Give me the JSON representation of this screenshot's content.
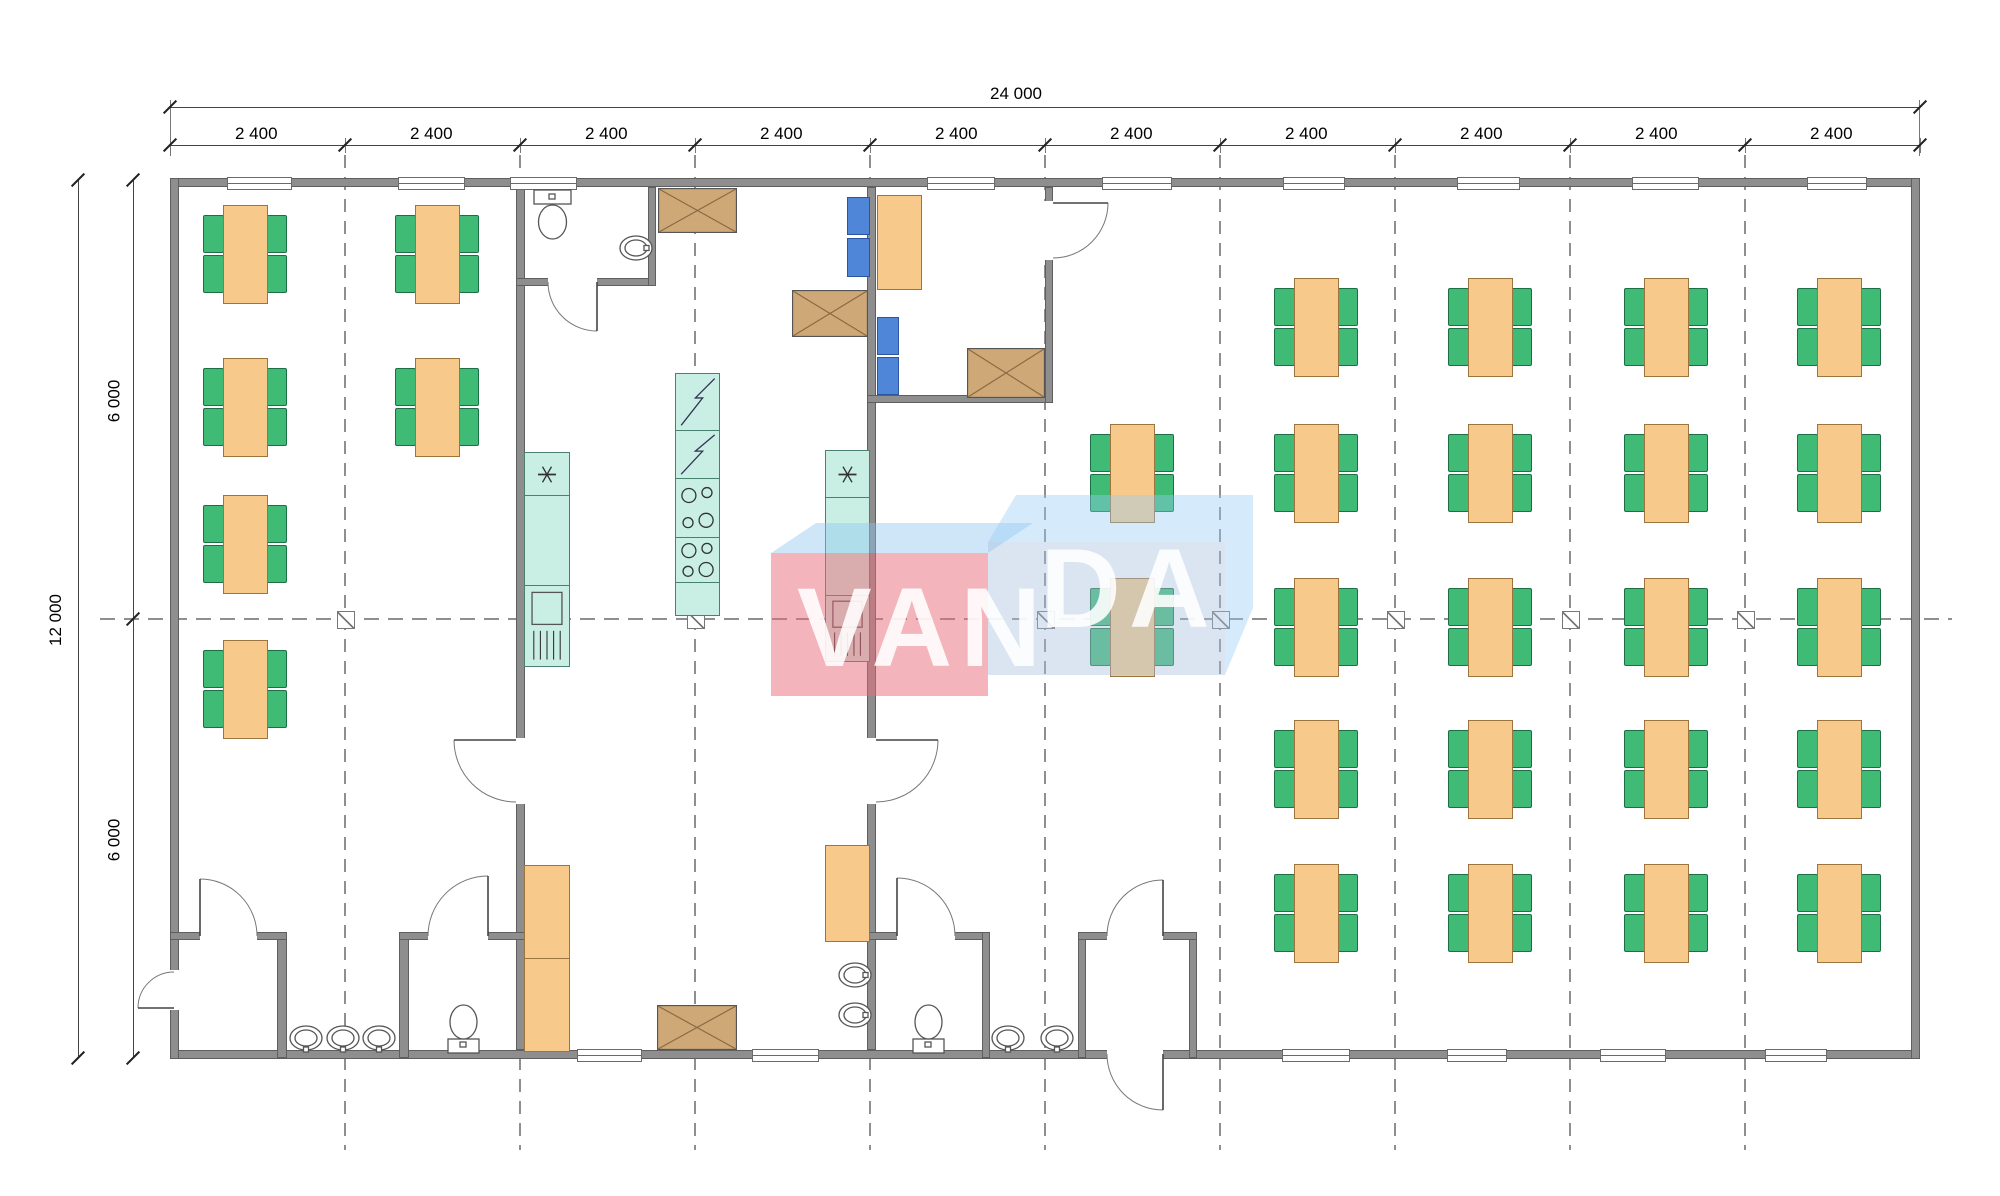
{
  "watermark": {
    "text": "VANDA",
    "text_left": "VAN",
    "text_right": "DA",
    "blue": "#9cc8ee",
    "red": "#e9697a"
  },
  "dims": {
    "total_width": "24 000",
    "total_height": "12 000",
    "half_height": "6 000",
    "bay_value": "2 400",
    "bay_centers": [
      257,
      432,
      607,
      782,
      957,
      1132,
      1307,
      1482,
      1657,
      1832
    ],
    "grid_ticks_x": [
      170,
      345,
      520,
      695,
      870,
      1045,
      1220,
      1395,
      1570,
      1745,
      1920
    ],
    "line1_y": 107,
    "line2_y": 145,
    "vline1_x": 78,
    "vline2_x": 133,
    "plan_top": 180,
    "plan_bottom": 1058,
    "plan_left": 170,
    "plan_right": 1920
  },
  "grid": {
    "vxs": [
      345,
      520,
      695,
      870,
      1045,
      1220,
      1395,
      1570,
      1745
    ],
    "v_y0": 155,
    "v_y1": 1150,
    "hy": 619,
    "h_x0": 100,
    "h_x1": 1952,
    "marker_xs": [
      345,
      695,
      1045,
      1220,
      1395,
      1570,
      1745
    ]
  },
  "walls": [
    [
      170,
      178,
      1750,
      9
    ],
    [
      170,
      1050,
      1750,
      9
    ],
    [
      170,
      178,
      9,
      881
    ],
    [
      1911,
      178,
      9,
      881
    ],
    [
      516,
      187,
      9,
      863
    ],
    [
      867,
      187,
      9,
      863
    ],
    [
      516,
      278,
      140,
      8
    ],
    [
      648,
      187,
      8,
      99
    ],
    [
      867,
      395,
      186,
      8
    ],
    [
      1045,
      187,
      8,
      216
    ],
    [
      277,
      932,
      10,
      126
    ],
    [
      399,
      932,
      10,
      126
    ],
    [
      170,
      932,
      117,
      8
    ],
    [
      399,
      932,
      126,
      8
    ],
    [
      867,
      932,
      123,
      8
    ],
    [
      982,
      932,
      8,
      126
    ],
    [
      1078,
      932,
      8,
      126
    ],
    [
      1189,
      932,
      8,
      126
    ],
    [
      1078,
      932,
      119,
      8
    ]
  ],
  "wall_gaps": [
    [
      548,
      276,
      49,
      12
    ],
    [
      514,
      738,
      13,
      66
    ],
    [
      865,
      738,
      13,
      66
    ],
    [
      1042,
      201,
      12,
      59
    ],
    [
      200,
      930,
      57,
      12
    ],
    [
      428,
      930,
      60,
      12
    ],
    [
      897,
      930,
      58,
      12
    ],
    [
      168,
      970,
      13,
      40
    ],
    [
      1107,
      930,
      56,
      12
    ],
    [
      1107,
      1048,
      56,
      13
    ]
  ],
  "windows_top": [
    [
      227,
      63
    ],
    [
      398,
      65
    ],
    [
      510,
      65
    ],
    [
      927,
      66
    ],
    [
      1102,
      68
    ],
    [
      1283,
      60
    ],
    [
      1457,
      61
    ],
    [
      1632,
      65
    ],
    [
      1807,
      58
    ]
  ],
  "windows_bottom": [
    [
      577,
      63
    ],
    [
      752,
      65
    ],
    [
      1282,
      66
    ],
    [
      1447,
      58
    ],
    [
      1600,
      64
    ],
    [
      1765,
      60
    ]
  ],
  "doors": [
    {
      "name": "wc-top-door",
      "h": [
        597,
        282
      ],
      "r": 49,
      "closed": 180,
      "open": 90
    },
    {
      "name": "kitchen-to-left-room-door",
      "h": [
        516,
        740
      ],
      "r": 62,
      "closed": 90,
      "open": 180
    },
    {
      "name": "kitchen-to-hall-door",
      "h": [
        876,
        740
      ],
      "r": 62,
      "closed": 90,
      "open": 0
    },
    {
      "name": "office-door",
      "h": [
        1053,
        203
      ],
      "r": 55,
      "closed": 90,
      "open": 0
    },
    {
      "name": "entry-vestibule-inner-door",
      "h": [
        200,
        936
      ],
      "r": 57,
      "closed": 0,
      "open": 270
    },
    {
      "name": "wc-left-door",
      "h": [
        488,
        936
      ],
      "r": 60,
      "closed": 180,
      "open": 270
    },
    {
      "name": "wc-mid-door",
      "h": [
        897,
        936
      ],
      "r": 58,
      "closed": 0,
      "open": 270
    },
    {
      "name": "entry-left-door",
      "h": [
        174,
        1008
      ],
      "r": 36,
      "closed": 270,
      "open": 180
    },
    {
      "name": "main-vestibule-inner-door",
      "h": [
        1163,
        936
      ],
      "r": 56,
      "closed": 180,
      "open": 270
    },
    {
      "name": "main-vestibule-outer-door",
      "h": [
        1163,
        1054
      ],
      "r": 56,
      "closed": 180,
      "open": 90
    }
  ],
  "dining_sets": [
    [
      244,
      253
    ],
    [
      244,
      406
    ],
    [
      244,
      543
    ],
    [
      244,
      688
    ],
    [
      436,
      253
    ],
    [
      436,
      406
    ],
    [
      1131,
      472
    ],
    [
      1131,
      626
    ],
    [
      1315,
      326
    ],
    [
      1315,
      472
    ],
    [
      1315,
      626
    ],
    [
      1315,
      768
    ],
    [
      1315,
      912
    ],
    [
      1489,
      326
    ],
    [
      1489,
      472
    ],
    [
      1489,
      626
    ],
    [
      1489,
      768
    ],
    [
      1489,
      912
    ],
    [
      1665,
      326
    ],
    [
      1665,
      472
    ],
    [
      1665,
      626
    ],
    [
      1665,
      768
    ],
    [
      1665,
      912
    ],
    [
      1838,
      326
    ],
    [
      1838,
      472
    ],
    [
      1838,
      626
    ],
    [
      1838,
      768
    ],
    [
      1838,
      912
    ]
  ],
  "table_size": [
    43,
    97
  ],
  "chair_size": [
    19,
    36
  ],
  "blue_chairs": [
    [
      847,
      197,
      21,
      36
    ],
    [
      847,
      238,
      21,
      37
    ],
    [
      877,
      317,
      20,
      36
    ],
    [
      877,
      357,
      20,
      36
    ]
  ],
  "orange_units": [
    {
      "name": "office-desk",
      "r": [
        877,
        195,
        43,
        93
      ]
    },
    {
      "name": "kitchen-cabinet",
      "r": [
        524,
        865,
        44,
        93
      ]
    },
    {
      "name": "kitchen-cabinet",
      "r": [
        524,
        958,
        44,
        92
      ]
    },
    {
      "name": "kitchen-counter",
      "r": [
        825,
        845,
        43,
        95
      ]
    }
  ],
  "cross_boxes": [
    [
      658,
      188,
      79,
      45
    ],
    [
      792,
      290,
      76,
      47
    ],
    [
      967,
      348,
      78,
      50
    ],
    [
      657,
      1005,
      80,
      45
    ]
  ],
  "teal_units": [
    {
      "t": "sink",
      "r": [
        524,
        452,
        44,
        43
      ]
    },
    {
      "t": "counter",
      "r": [
        524,
        495,
        44,
        90
      ]
    },
    {
      "t": "dw",
      "r": [
        524,
        585,
        44,
        80
      ]
    },
    {
      "t": "fridge",
      "r": [
        675,
        373,
        43,
        57
      ]
    },
    {
      "t": "fridge",
      "r": [
        675,
        430,
        43,
        48
      ]
    },
    {
      "t": "stove",
      "r": [
        675,
        478,
        43,
        59
      ]
    },
    {
      "t": "stove",
      "r": [
        675,
        537,
        43,
        45
      ]
    },
    {
      "t": "counter",
      "r": [
        675,
        582,
        43,
        32
      ]
    },
    {
      "t": "sink",
      "r": [
        825,
        450,
        43,
        47
      ]
    },
    {
      "t": "counter",
      "r": [
        825,
        497,
        43,
        98
      ]
    },
    {
      "t": "dw",
      "r": [
        825,
        595,
        43,
        65
      ]
    }
  ],
  "toilets": [
    {
      "o": "down",
      "x": 533,
      "y": 188
    },
    {
      "o": "up",
      "x": 446,
      "y": 1001
    },
    {
      "o": "up",
      "x": 911,
      "y": 1001
    }
  ],
  "basins": [
    {
      "c": [
        636,
        248
      ],
      "tap": "e"
    },
    {
      "c": [
        855,
        975
      ],
      "tap": "e"
    },
    {
      "c": [
        855,
        1015
      ],
      "tap": "e"
    },
    {
      "c": [
        1008,
        1038
      ],
      "tap": "s"
    },
    {
      "c": [
        1057,
        1038
      ],
      "tap": "s"
    },
    {
      "c": [
        306,
        1038
      ],
      "tap": "s"
    },
    {
      "c": [
        343,
        1038
      ],
      "tap": "s"
    },
    {
      "c": [
        379,
        1038
      ],
      "tap": "s"
    }
  ],
  "colors": {
    "wall": "#8e8e8e",
    "table": "#f7ca8c",
    "chair": "#3fbb75",
    "blue_chair": "#4f86d8",
    "cabinet_tan": "#cfa878",
    "appliance_teal": "#c9efe4",
    "dash": "#8f8f8f"
  }
}
